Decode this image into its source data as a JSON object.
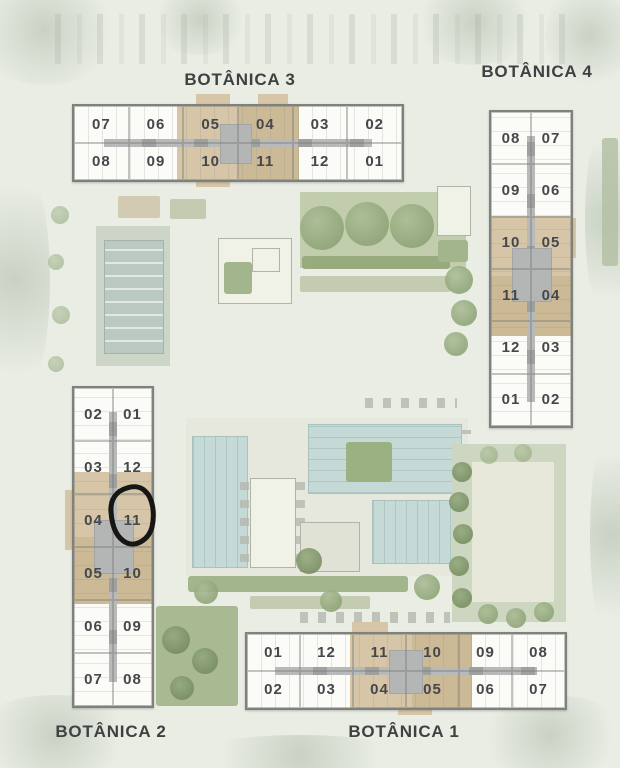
{
  "buildings": [
    {
      "id": "botanica-3",
      "label": "BOTÂNICA 3",
      "rows": [
        [
          "07",
          "06",
          "05",
          "04",
          "03",
          "02"
        ],
        [
          "08",
          "09",
          "10",
          "11",
          "12",
          "01"
        ]
      ]
    },
    {
      "id": "botanica-4",
      "label": "BOTÂNICA 4",
      "rows": [
        [
          "08",
          "07"
        ],
        [
          "09",
          "06"
        ],
        [
          "10",
          "05"
        ],
        [
          "11",
          "04"
        ],
        [
          "12",
          "03"
        ],
        [
          "01",
          "02"
        ]
      ]
    },
    {
      "id": "botanica-2",
      "label": "BOTÂNICA 2",
      "rows": [
        [
          "02",
          "01"
        ],
        [
          "03",
          "12"
        ],
        [
          "04",
          "11"
        ],
        [
          "05",
          "10"
        ],
        [
          "06",
          "09"
        ],
        [
          "07",
          "08"
        ]
      ]
    },
    {
      "id": "botanica-1",
      "label": "BOTÂNICA 1",
      "rows": [
        [
          "01",
          "12",
          "11",
          "10",
          "09",
          "08"
        ],
        [
          "02",
          "03",
          "04",
          "05",
          "06",
          "07"
        ]
      ]
    }
  ],
  "annotation": {
    "type": "hand-drawn-circle",
    "circled_unit": "11",
    "circled_building": "BOTÂNICA 2",
    "color": "#161616"
  },
  "colors": {
    "background": "#e9ede4",
    "building_fill": "#fbfbf8",
    "building_border": "#7f817c",
    "unit_number": "#45474a",
    "core_tan": "#d6c6a7",
    "core_gray": "#b3b6b4",
    "pool": "#c5dad7",
    "court": "#bac9c2",
    "tree": "#8aa173",
    "title": "#3e4042"
  }
}
